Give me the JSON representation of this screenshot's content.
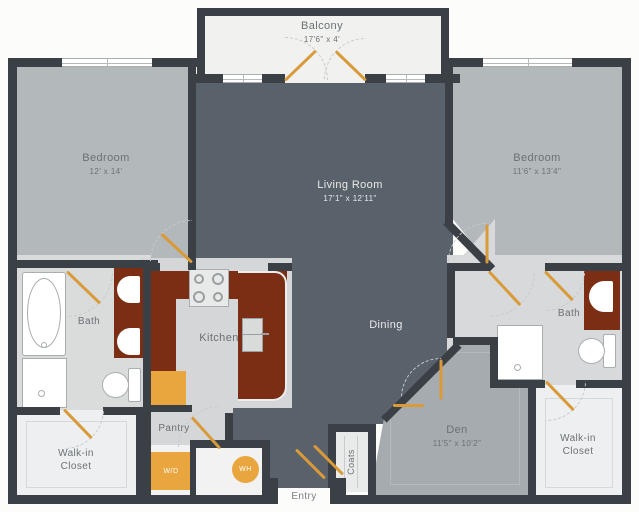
{
  "rooms": {
    "balcony": {
      "name": "Balcony",
      "dims": "17'6\" x 4'"
    },
    "bedroom_left": {
      "name": "Bedroom",
      "dims": "12' x 14'"
    },
    "bedroom_right": {
      "name": "Bedroom",
      "dims": "11'6\" x 13'4\""
    },
    "living_room": {
      "name": "Living Room",
      "dims": "17'1\" x 12'11\""
    },
    "dining": {
      "name": "Dining"
    },
    "kitchen": {
      "name": "Kitchen"
    },
    "bath_left": {
      "name": "Bath"
    },
    "bath_right": {
      "name": "Bath"
    },
    "den": {
      "name": "Den",
      "dims": "11'5\" x 10'2\""
    },
    "closet_left": {
      "name": "Walk-in Closet"
    },
    "closet_right": {
      "name": "Walk-in Closet"
    },
    "pantry": {
      "name": "Pantry"
    },
    "coats": {
      "name": "Coats"
    },
    "entry": {
      "name": "Entry"
    }
  },
  "appliances": {
    "washer_dryer": "W/D",
    "water_heater": "WH"
  },
  "colors": {
    "wall": "#3b4046",
    "living_floor": "#59616a",
    "bedroom_floor": "#b3b8bb",
    "den_floor": "#a6abaf",
    "bath_floor": "#d8d9da",
    "closet_floor": "#edeff0",
    "balcony_floor": "#f1f2ef",
    "counter": "#7c2e14",
    "appliance_orange": "#e9a53e",
    "door_swing": "#d99b3a"
  }
}
